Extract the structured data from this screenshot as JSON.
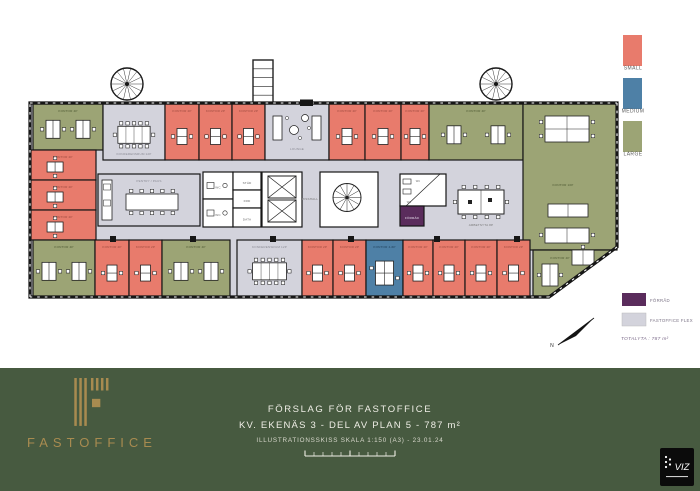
{
  "colors": {
    "small": "#E87B6C",
    "medium": "#4E80A6",
    "large": "#9CA475",
    "conf": "#D3D3DC",
    "floor": "#D3D3DC",
    "flex": "#D3D3DC",
    "service": "#FFFFFF",
    "forrad": "#5A2C5C",
    "wall": "#161616",
    "footer_bg": "#475A40",
    "gold": "#A88B50"
  },
  "label_colors": {
    "small": "#9c4a3f",
    "medium": "#1f3d57",
    "large": "#4e5933",
    "conf": "#8b8b95",
    "floor": "#8b8b95",
    "service": "#6a6a6a",
    "forrad": "#e9e0ef"
  },
  "legend": {
    "sizes": [
      {
        "label": "SMALL",
        "type": "small"
      },
      {
        "label": "MEDIUM",
        "type": "medium"
      },
      {
        "label": "LARGE",
        "type": "large"
      }
    ],
    "extras": [
      {
        "label": "FÖRRÅD",
        "type": "forrad"
      },
      {
        "label": "FASTOFFICE FLEX",
        "type": "flex"
      }
    ],
    "total": "TOTALYTA : 787 m²"
  },
  "north_label": "N",
  "footer": {
    "brand": "FASTOFFICE",
    "line1": "FÖRSLAG FÖR FASTOFFICE",
    "line2": "KV. EKENÄS 3 - DEL AV PLAN 5 - 787 m²",
    "line3": "ILLUSTRATIONSSKISS SKALA 1:150 (A3) - 23.01.24",
    "viz": "VIZ"
  },
  "plan": {
    "outline": [
      [
        30,
        103
      ],
      [
        617,
        103
      ],
      [
        617,
        247
      ],
      [
        549,
        297
      ],
      [
        30,
        297
      ]
    ],
    "stairs": [
      {
        "cx": 127,
        "cy": 84,
        "r": 16
      },
      {
        "cx": 496,
        "cy": 84,
        "r": 16
      }
    ],
    "shaft": {
      "x": 253,
      "y": 60,
      "w": 20,
      "h": 44
    },
    "entrance": {
      "x": 300,
      "y": 99.5,
      "w": 13,
      "h": 6.5
    },
    "columns": {
      "y": 236,
      "size": 6,
      "xs": [
        110,
        190,
        270,
        348,
        434,
        514
      ]
    },
    "free_labels": [
      {
        "text": "HISSHALL",
        "x": 310,
        "y": 200
      },
      {
        "text": "ARBETSYTA 8P",
        "x": 481,
        "y": 226
      }
    ],
    "arbetsyta_table": {
      "x": 458,
      "y": 190,
      "w": 46,
      "h": 24
    },
    "rooms": [
      {
        "label": "KONTOR 4P",
        "type": "large",
        "x": 33,
        "y": 104,
        "w": 70,
        "h": 46,
        "furn": "desks2h",
        "lpos": "top"
      },
      {
        "label": "KONFERENSRUM 12P",
        "type": "conf",
        "x": 103,
        "y": 104,
        "w": 62,
        "h": 56,
        "furn": "conftable",
        "lpos": "bottom"
      },
      {
        "label": "KONTOR 2P",
        "type": "small",
        "x": 165,
        "y": 104,
        "w": 34,
        "h": 56,
        "furn": "deskv",
        "lpos": "top"
      },
      {
        "label": "KONTOR 2P",
        "type": "small",
        "x": 199,
        "y": 104,
        "w": 33,
        "h": 56,
        "furn": "deskv",
        "lpos": "top"
      },
      {
        "label": "KONTOR 2P",
        "type": "small",
        "x": 232,
        "y": 104,
        "w": 33,
        "h": 56,
        "furn": "deskv",
        "lpos": "top"
      },
      {
        "label": "LOUNGE",
        "type": "floor",
        "x": 265,
        "y": 104,
        "w": 64,
        "h": 56,
        "furn": "lounge",
        "lpos": "center"
      },
      {
        "label": "KONTOR 2P",
        "type": "small",
        "x": 329,
        "y": 104,
        "w": 36,
        "h": 56,
        "furn": "deskv",
        "lpos": "top"
      },
      {
        "label": "KONTOR 2P",
        "type": "small",
        "x": 365,
        "y": 104,
        "w": 36,
        "h": 56,
        "furn": "deskv",
        "lpos": "top"
      },
      {
        "label": "KONTOR 2P",
        "type": "small",
        "x": 401,
        "y": 104,
        "w": 28,
        "h": 56,
        "furn": "deskv",
        "lpos": "top"
      },
      {
        "label": "KONTOR 4P",
        "type": "large",
        "x": 429,
        "y": 104,
        "w": 94,
        "h": 56,
        "furn": "desks2h",
        "lpos": "top"
      },
      {
        "label": "KONTOR 10P",
        "type": "large",
        "x": 523,
        "y": 104,
        "w": 94,
        "h": 146,
        "furn": "desks10",
        "lx": 563,
        "ly": 186
      },
      {
        "label": "KONTOR 2P",
        "type": "small",
        "x": 30,
        "y": 150,
        "w": 66,
        "h": 30,
        "furn": "deskh",
        "lpos": "top"
      },
      {
        "label": "KONTOR 2P",
        "type": "small",
        "x": 30,
        "y": 180,
        "w": 66,
        "h": 30,
        "furn": "deskh",
        "lpos": "top"
      },
      {
        "label": "KONTOR 2P",
        "type": "small",
        "x": 30,
        "y": 210,
        "w": 66,
        "h": 30,
        "furn": "deskh",
        "lpos": "top"
      },
      {
        "label": "PENTRY / PAUS",
        "type": "conf",
        "x": 98,
        "y": 174,
        "w": 102,
        "h": 52,
        "furn": "pentry",
        "lpos": "top"
      },
      {
        "label": "WC",
        "type": "service",
        "x": 203,
        "y": 172,
        "w": 30,
        "h": 27,
        "furn": "wc",
        "lpos": "center"
      },
      {
        "label": "WC",
        "type": "service",
        "x": 203,
        "y": 199,
        "w": 30,
        "h": 28,
        "furn": "wc",
        "lpos": "center"
      },
      {
        "label": "STÄD",
        "type": "service",
        "x": 233,
        "y": 172,
        "w": 28,
        "h": 18,
        "lpos": "center"
      },
      {
        "label": "FRD",
        "type": "service",
        "x": 233,
        "y": 190,
        "w": 28,
        "h": 18,
        "lpos": "center"
      },
      {
        "label": "DATA",
        "type": "service",
        "x": 233,
        "y": 208,
        "w": 28,
        "h": 19,
        "lpos": "center"
      },
      {
        "label": "",
        "type": "service",
        "x": 262,
        "y": 172,
        "w": 40,
        "h": 55,
        "furn": "elevators"
      },
      {
        "label": "",
        "type": "service",
        "x": 320,
        "y": 172,
        "w": 58,
        "h": 55,
        "furn": "spiral"
      },
      {
        "label": "",
        "type": "service",
        "x": 400,
        "y": 174,
        "w": 46,
        "h": 32,
        "furn": "wcsplit"
      },
      {
        "label": "FÖRRÅD",
        "type": "forrad",
        "x": 400,
        "y": 206,
        "w": 24,
        "h": 20,
        "lpos": "center"
      },
      {
        "label": "KONTOR 4P",
        "type": "large",
        "x": 33,
        "y": 240,
        "w": 62,
        "h": 57,
        "furn": "desks2h",
        "lpos": "top"
      },
      {
        "label": "KONTOR 2P",
        "type": "small",
        "x": 95,
        "y": 240,
        "w": 34,
        "h": 57,
        "furn": "deskv",
        "lpos": "top"
      },
      {
        "label": "KONTOR 2P",
        "type": "small",
        "x": 129,
        "y": 240,
        "w": 33,
        "h": 57,
        "furn": "deskv",
        "lpos": "top"
      },
      {
        "label": "KONTOR 4P",
        "type": "large",
        "x": 162,
        "y": 240,
        "w": 68,
        "h": 57,
        "furn": "desks2h",
        "lpos": "top"
      },
      {
        "label": "KONFERENSRUM 12P",
        "type": "conf",
        "x": 237,
        "y": 240,
        "w": 65,
        "h": 57,
        "furn": "conftable",
        "lpos": "top"
      },
      {
        "label": "KONTOR 2P",
        "type": "small",
        "x": 302,
        "y": 240,
        "w": 31,
        "h": 57,
        "furn": "deskv",
        "lpos": "top"
      },
      {
        "label": "KONTOR 2P",
        "type": "small",
        "x": 333,
        "y": 240,
        "w": 33,
        "h": 57,
        "furn": "deskv",
        "lpos": "top"
      },
      {
        "label": "KONTOR 4-6P",
        "type": "medium",
        "x": 366,
        "y": 240,
        "w": 37,
        "h": 57,
        "furn": "deskpair",
        "lpos": "top"
      },
      {
        "label": "KONTOR 2P",
        "type": "small",
        "x": 403,
        "y": 240,
        "w": 30,
        "h": 57,
        "furn": "deskv",
        "lpos": "top"
      },
      {
        "label": "KONTOR 2P",
        "type": "small",
        "x": 433,
        "y": 240,
        "w": 32,
        "h": 57,
        "furn": "deskv",
        "lpos": "top"
      },
      {
        "label": "KONTOR 2P",
        "type": "small",
        "x": 465,
        "y": 240,
        "w": 32,
        "h": 57,
        "furn": "deskv",
        "lpos": "top"
      },
      {
        "label": "KONTOR 2P",
        "type": "small",
        "x": 497,
        "y": 240,
        "w": 33,
        "h": 57,
        "furn": "deskv",
        "lpos": "top"
      },
      {
        "label": "KONTOR 4P",
        "type": "large",
        "points": [
          [
            533,
            250
          ],
          [
            614,
            250
          ],
          [
            552,
            296
          ],
          [
            533,
            296
          ]
        ],
        "furn": "desksLow",
        "lx": 560,
        "ly": 259
      }
    ]
  }
}
